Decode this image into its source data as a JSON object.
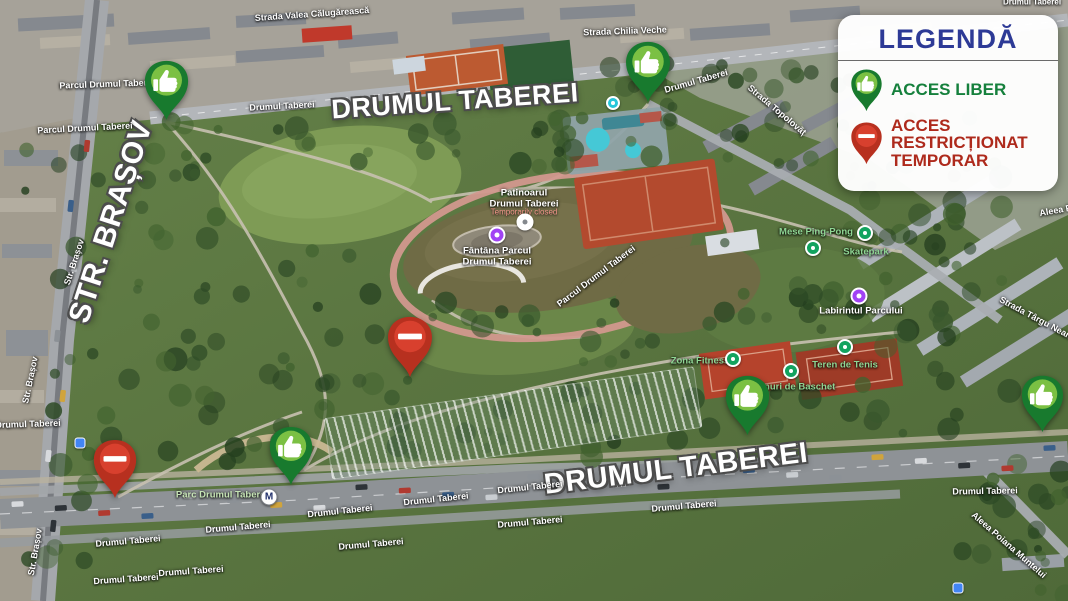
{
  "legend": {
    "title": "LEGENDĂ",
    "items": [
      {
        "id": "free",
        "icon": "thumbs-up-pin-icon",
        "label": "ACCES LIBER",
        "color": "#15803c"
      },
      {
        "id": "restricted",
        "icon": "no-entry-pin-icon",
        "label": "ACCES RESTRICȚIONAT TEMPORAR",
        "color": "#ae2a1c"
      }
    ]
  },
  "colors": {
    "legend_title": "#2d3a96",
    "pin_free_dark": "#187a2e",
    "pin_free_light": "#7bc043",
    "pin_restricted_dark": "#b7301f",
    "pin_restricted_light": "#d8402e",
    "pin_glyph": "#ffffff",
    "poi_green_label": "#8fd694",
    "park_label": "#c6e4b5"
  },
  "map": {
    "labels": [
      {
        "text": "DRUMUL TABEREI",
        "x": 455,
        "y": 101,
        "r": -4,
        "kind": "major",
        "size": 27
      },
      {
        "text": "DRUMUL TABEREI",
        "x": 676,
        "y": 469,
        "r": -7,
        "kind": "major",
        "size": 29
      },
      {
        "text": "STR. BRAȘOV",
        "x": 111,
        "y": 222,
        "r": -72,
        "kind": "major",
        "size": 30
      },
      {
        "text": "Strada Valea Călugărească",
        "x": 312,
        "y": 14,
        "r": -4,
        "kind": "street"
      },
      {
        "text": "Strada Chilia Veche",
        "x": 625,
        "y": 31,
        "r": -2,
        "kind": "street"
      },
      {
        "text": "Drumul Taberei",
        "x": 282,
        "y": 106,
        "r": -3,
        "kind": "street"
      },
      {
        "text": "Parcul Drumul Taberei",
        "x": 107,
        "y": 84,
        "r": -2,
        "kind": "street"
      },
      {
        "text": "Parcul Drumul Taberei",
        "x": 85,
        "y": 128,
        "r": -3,
        "kind": "street"
      },
      {
        "text": "Drumul Taberei",
        "x": 696,
        "y": 81,
        "r": -16,
        "kind": "street"
      },
      {
        "text": "Strada Topolovăț",
        "x": 777,
        "y": 110,
        "r": 40,
        "kind": "street"
      },
      {
        "text": "Drumul Taberei",
        "x": 1032,
        "y": 3,
        "r": 0,
        "kind": "street",
        "size": 8
      },
      {
        "text": "Aleea Pa",
        "x": 1058,
        "y": 210,
        "r": -10,
        "kind": "street"
      },
      {
        "text": "Strada Târgu Neamț",
        "x": 1038,
        "y": 319,
        "r": 28,
        "kind": "street"
      },
      {
        "text": "Str. Brașov",
        "x": 74,
        "y": 262,
        "r": -72,
        "kind": "street"
      },
      {
        "text": "Str. Brașov",
        "x": 30,
        "y": 380,
        "r": -78,
        "kind": "street"
      },
      {
        "text": "Str. Brașov",
        "x": 35,
        "y": 552,
        "r": -80,
        "kind": "street"
      },
      {
        "text": "Drumul Taberei",
        "x": 28,
        "y": 424,
        "r": -2,
        "kind": "street"
      },
      {
        "text": "Drumul Taberei",
        "x": 128,
        "y": 541,
        "r": -5,
        "kind": "street"
      },
      {
        "text": "Drumul Taberei",
        "x": 126,
        "y": 579,
        "r": -4,
        "kind": "street"
      },
      {
        "text": "Drumul Taberei",
        "x": 191,
        "y": 571,
        "r": -4,
        "kind": "street"
      },
      {
        "text": "Drumul Taberei",
        "x": 238,
        "y": 527,
        "r": -5,
        "kind": "street"
      },
      {
        "text": "Drumul Taberei",
        "x": 340,
        "y": 511,
        "r": -6,
        "kind": "street"
      },
      {
        "text": "Drumul Taberei",
        "x": 371,
        "y": 544,
        "r": -5,
        "kind": "street"
      },
      {
        "text": "Drumul Taberei",
        "x": 436,
        "y": 499,
        "r": -6,
        "kind": "street"
      },
      {
        "text": "Drumul Taberei",
        "x": 530,
        "y": 487,
        "r": -6,
        "kind": "street"
      },
      {
        "text": "Drumul Taberei",
        "x": 530,
        "y": 522,
        "r": -5,
        "kind": "street"
      },
      {
        "text": "Drumul Taberei",
        "x": 684,
        "y": 506,
        "r": -5,
        "kind": "street"
      },
      {
        "text": "Drumul Taberei",
        "x": 985,
        "y": 491,
        "r": -1,
        "kind": "street"
      },
      {
        "text": "Aleea Poiana Muntelui",
        "x": 1009,
        "y": 545,
        "r": 41,
        "kind": "street"
      },
      {
        "text": "Parcul Drumul Taberei",
        "x": 596,
        "y": 276,
        "r": -37,
        "kind": "street"
      },
      {
        "text": "Patinoarul\nDrumul Taberei",
        "x": 524,
        "y": 199,
        "r": 0,
        "kind": "poi-white"
      },
      {
        "text": "Temporarily closed",
        "x": 524,
        "y": 213,
        "r": 0,
        "kind": "closed"
      },
      {
        "text": "Fântâna Parcul\nDrumul Taberei",
        "x": 497,
        "y": 257,
        "r": 0,
        "kind": "poi-white"
      },
      {
        "text": "Mese Ping-Pong",
        "x": 816,
        "y": 233,
        "r": 0,
        "kind": "poi-green"
      },
      {
        "text": "Skatepark",
        "x": 866,
        "y": 253,
        "r": 0,
        "kind": "poi-green"
      },
      {
        "text": "Labirintul Parcului",
        "x": 861,
        "y": 312,
        "r": 0,
        "kind": "poi-white"
      },
      {
        "text": "Zona Fitness",
        "x": 700,
        "y": 362,
        "r": 0,
        "kind": "poi-green"
      },
      {
        "text": "Teren de Tenis",
        "x": 845,
        "y": 366,
        "r": 0,
        "kind": "poi-green"
      },
      {
        "text": "Terenuri de Baschet",
        "x": 790,
        "y": 388,
        "r": 0,
        "kind": "poi-green"
      },
      {
        "text": "Parc Drumul Taberei",
        "x": 222,
        "y": 496,
        "r": 0,
        "kind": "park"
      }
    ],
    "markers": [
      {
        "type": "free",
        "x": 166,
        "y": 121,
        "s": 47
      },
      {
        "type": "free",
        "x": 648,
        "y": 103,
        "s": 48
      },
      {
        "type": "free",
        "x": 291,
        "y": 486,
        "s": 46
      },
      {
        "type": "free",
        "x": 747,
        "y": 436,
        "s": 47
      },
      {
        "type": "free",
        "x": 1042,
        "y": 433,
        "s": 45
      },
      {
        "type": "restricted",
        "x": 410,
        "y": 378,
        "s": 48
      },
      {
        "type": "restricted",
        "x": 115,
        "y": 499,
        "s": 46
      }
    ],
    "poi_icons": [
      {
        "type": "closed-poi",
        "x": 525,
        "y": 222
      },
      {
        "type": "fountain-poi",
        "x": 497,
        "y": 235
      },
      {
        "type": "labyrinth-poi",
        "x": 859,
        "y": 296
      },
      {
        "type": "pingpong-poi",
        "x": 813,
        "y": 248
      },
      {
        "type": "skatepark-poi",
        "x": 865,
        "y": 233
      },
      {
        "type": "fitness-poi",
        "x": 733,
        "y": 359
      },
      {
        "type": "tennis-poi",
        "x": 845,
        "y": 347
      },
      {
        "type": "basketball-poi",
        "x": 791,
        "y": 371
      },
      {
        "type": "metro-station",
        "x": 269,
        "y": 497,
        "glyph": "M"
      },
      {
        "type": "poi-teal",
        "x": 613,
        "y": 103
      },
      {
        "type": "transit-blue",
        "x": 80,
        "y": 443
      },
      {
        "type": "transit-blue",
        "x": 958,
        "y": 588
      }
    ]
  }
}
